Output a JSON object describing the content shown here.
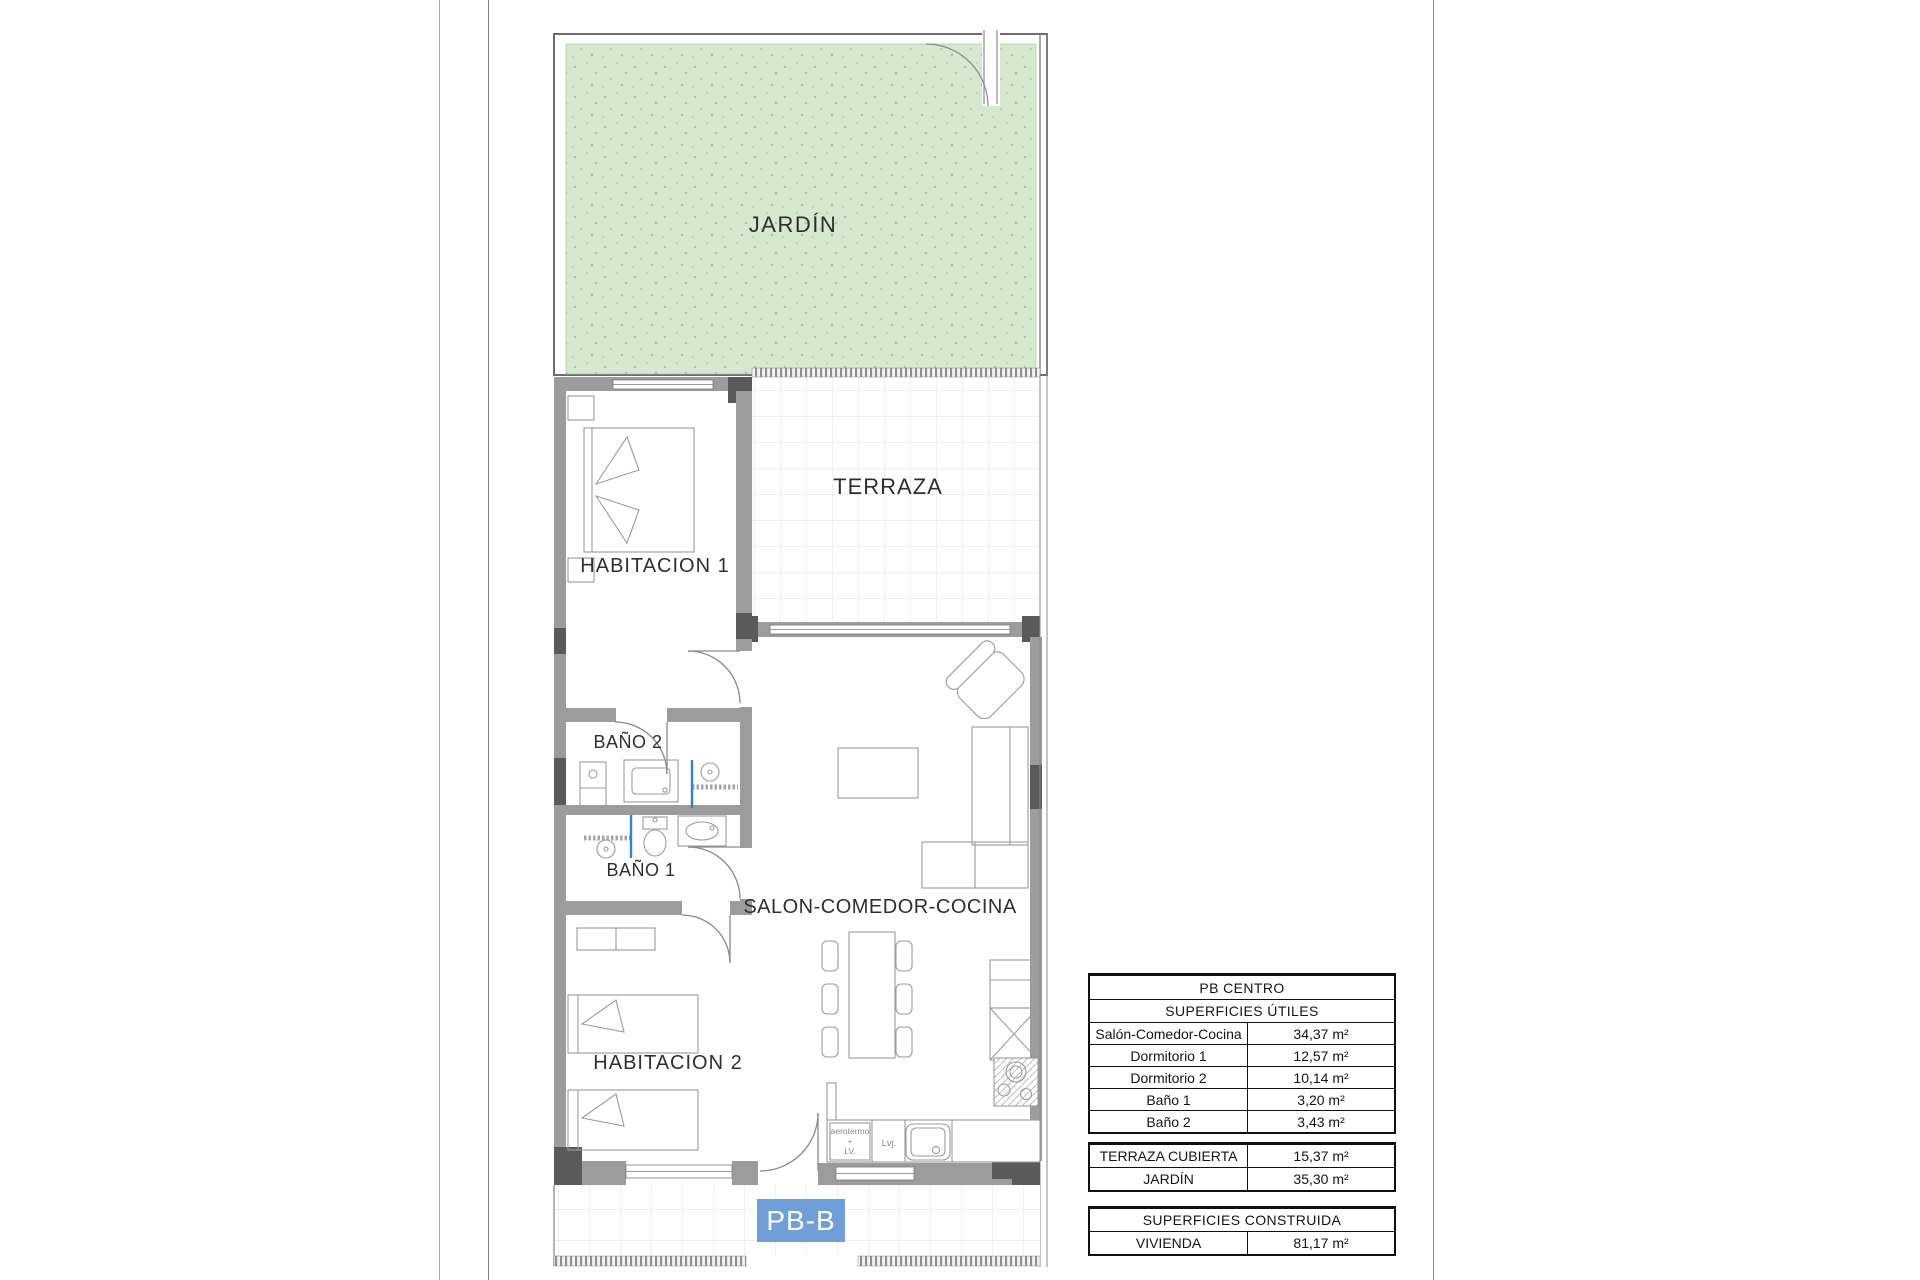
{
  "plan": {
    "unit_label": "PB-B",
    "rooms": {
      "jardin": "JARDÍN",
      "terraza": "TERRAZA",
      "habitacion1": "HABITACION 1",
      "bano2": "BAÑO 2",
      "bano1": "BAÑO 1",
      "salon": "SALON-COMEDOR-COCINA",
      "habitacion2": "HABITACION 2"
    },
    "kitchen_annotations": {
      "aerotermo_line1": "aerotermo",
      "aerotermo_line2": "+",
      "aerotermo_line3": "LV.",
      "lvj": "Lvj."
    }
  },
  "tables": {
    "useful": {
      "title": "PB CENTRO",
      "subtitle": "SUPERFICIES ÚTILES",
      "rows": [
        {
          "label": "Salón-Comedor-Cocina",
          "value": "34,37 m²"
        },
        {
          "label": "Dormitorio 1",
          "value": "12,57 m²"
        },
        {
          "label": "Dormitorio 2",
          "value": "10,14 m²"
        },
        {
          "label": "Baño 1",
          "value": "3,20 m²"
        },
        {
          "label": "Baño 2",
          "value": "3,43 m²"
        }
      ]
    },
    "exterior": {
      "rows": [
        {
          "label": "TERRAZA CUBIERTA",
          "value": "15,37 m²"
        },
        {
          "label": "JARDÍN",
          "value": "35,30 m²"
        }
      ]
    },
    "built": {
      "title": "SUPERFICIES CONSTRUIDA",
      "rows": [
        {
          "label": "VIVIENDA",
          "value": "81,17 m²"
        }
      ]
    }
  },
  "colors": {
    "garden_green": "#d6e8cf",
    "wall_gray": "#9c9c9c",
    "corner_dark": "#5a5a5a",
    "unit_badge_blue": "#6f9ed8",
    "shower_blue": "#2e86d0"
  }
}
